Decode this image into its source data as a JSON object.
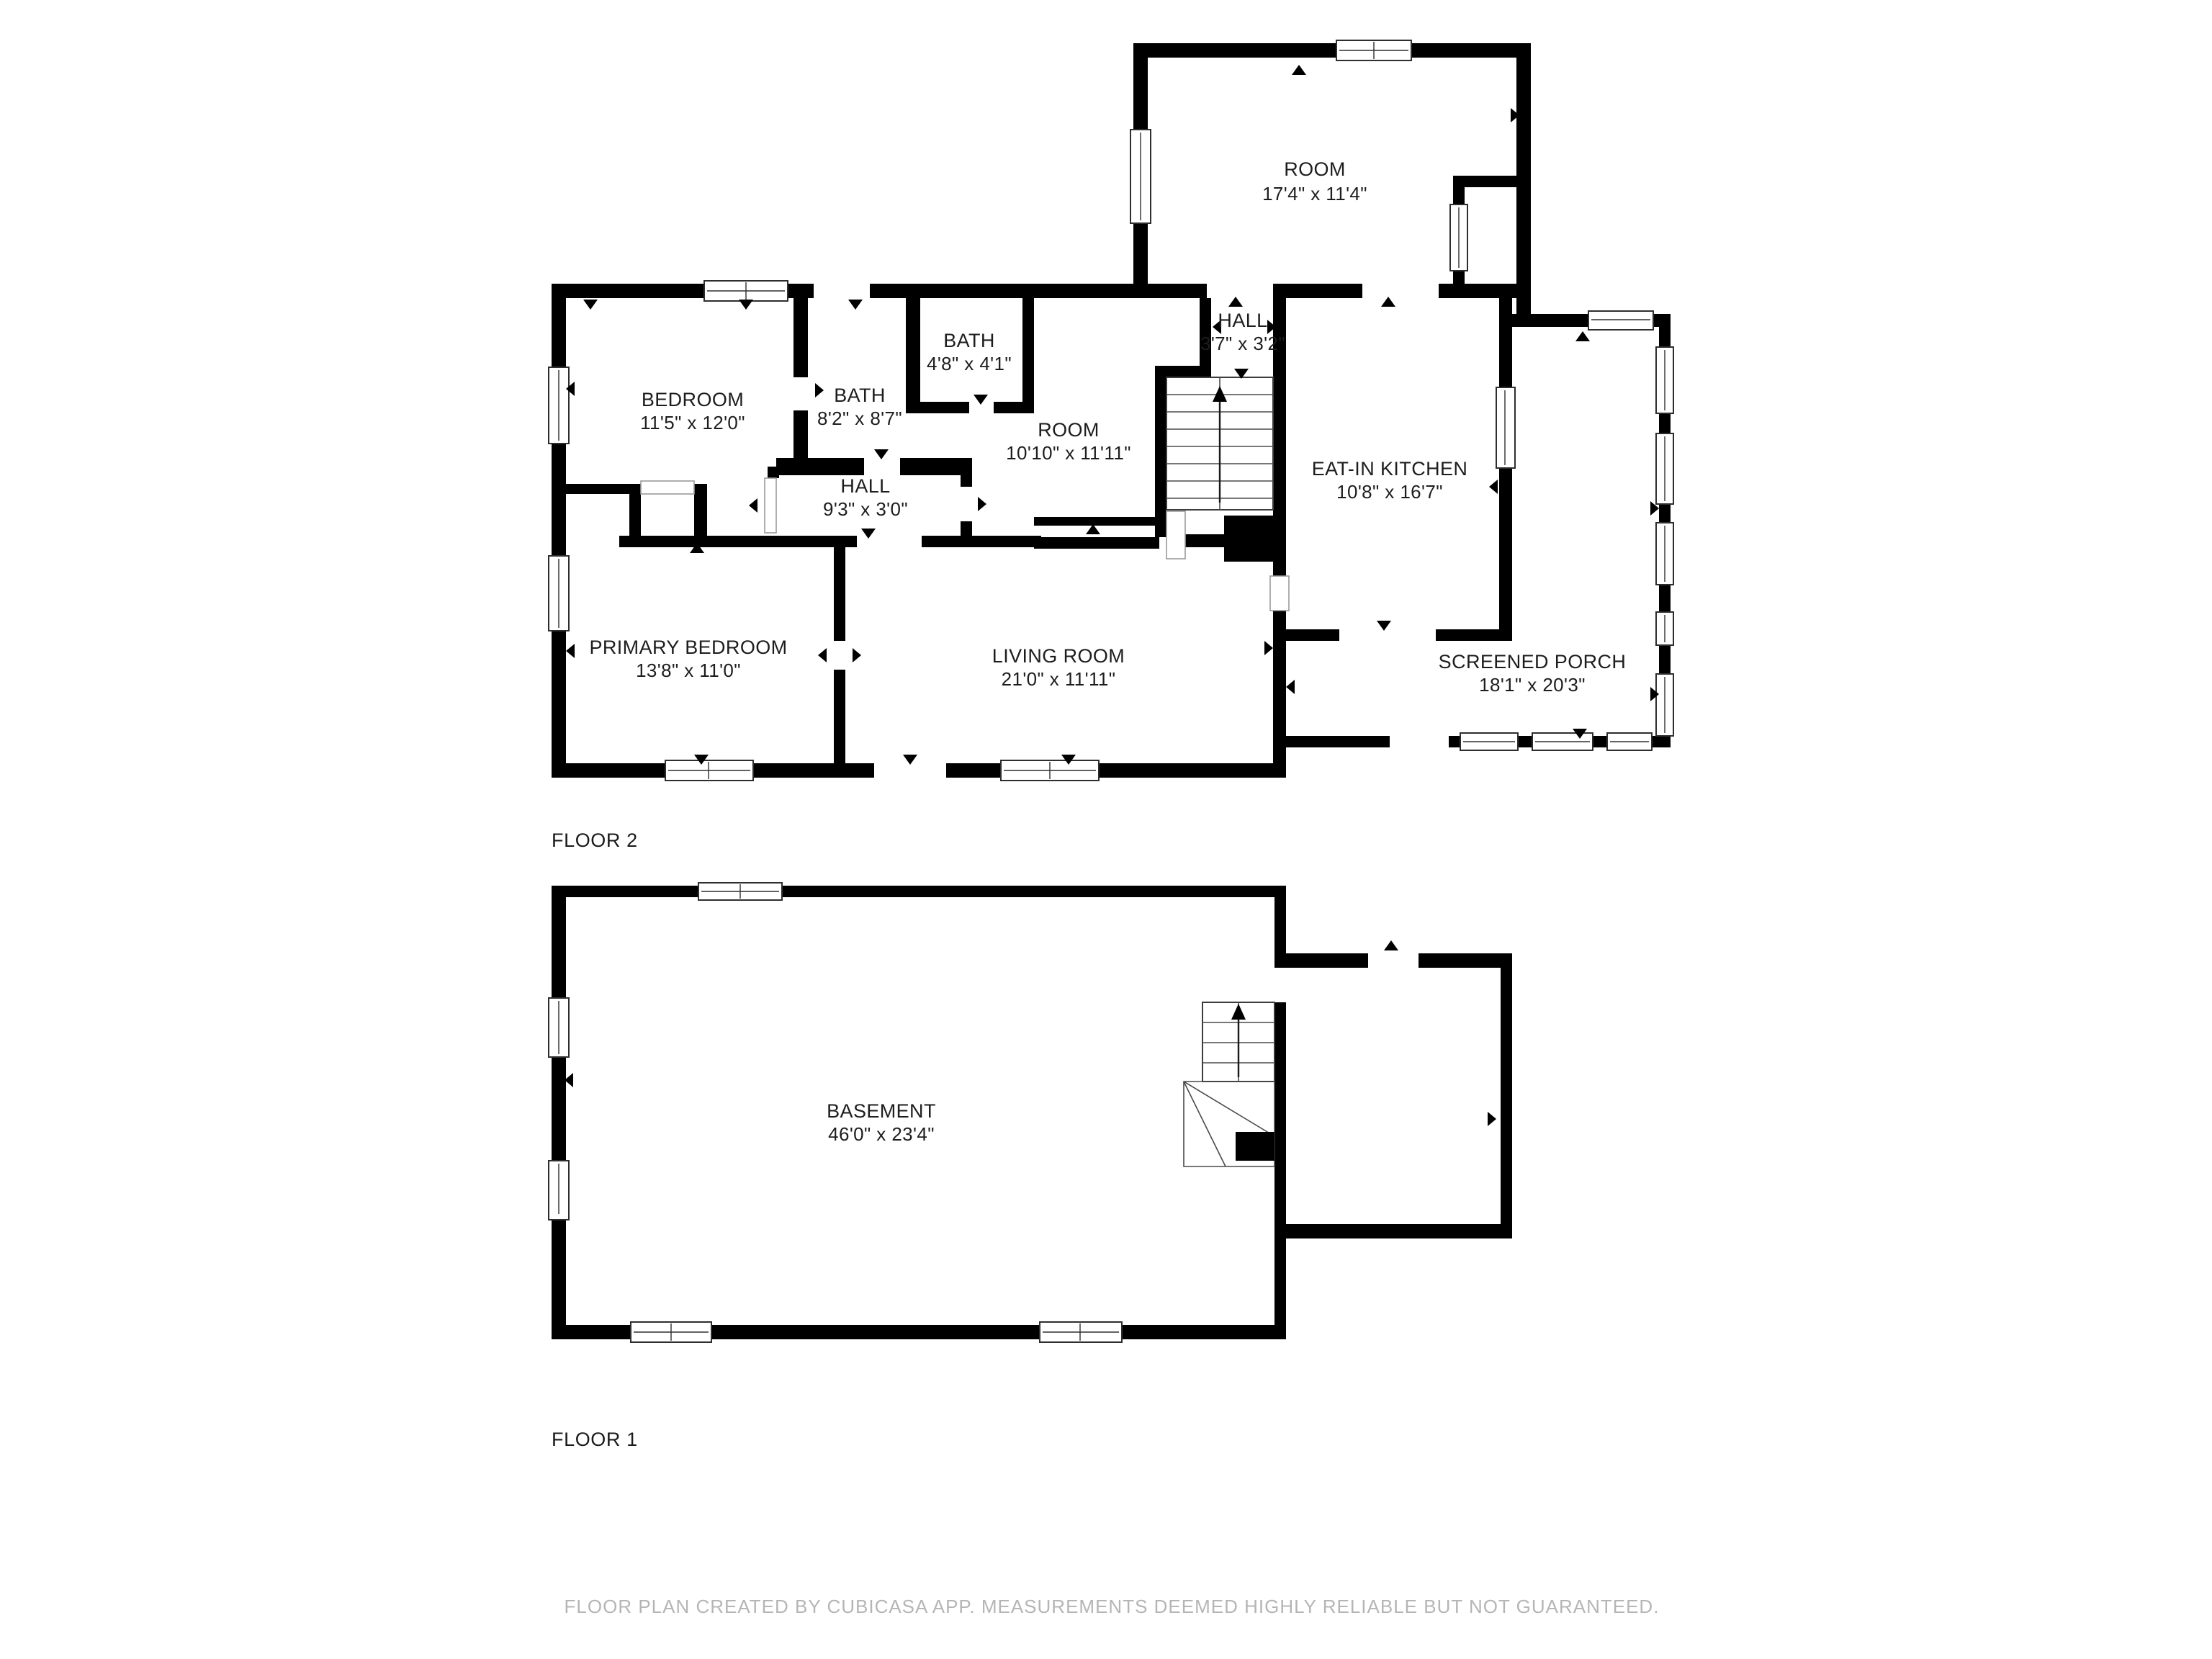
{
  "colors": {
    "wall": "#000000",
    "background": "#ffffff",
    "label_text": "#1d1d1d",
    "footer_text": "#b5b5b5",
    "window_line": "#2e2e2e"
  },
  "floor2": {
    "label": "FLOOR 2",
    "rooms": [
      {
        "name": "ROOM",
        "dims": "17'4\" x 11'4\""
      },
      {
        "name": "BATH",
        "dims": "4'8\" x 4'1\""
      },
      {
        "name": "BATH",
        "dims": "8'2\" x 8'7\""
      },
      {
        "name": "BEDROOM",
        "dims": "11'5\" x 12'0\""
      },
      {
        "name": "HALL",
        "dims": "3'7\" x 3'2\""
      },
      {
        "name": "ROOM",
        "dims": "10'10\" x 11'11\""
      },
      {
        "name": "EAT-IN KITCHEN",
        "dims": "10'8\" x 16'7\""
      },
      {
        "name": "HALL",
        "dims": "9'3\" x 3'0\""
      },
      {
        "name": "PRIMARY BEDROOM",
        "dims": "13'8\" x 11'0\""
      },
      {
        "name": "LIVING ROOM",
        "dims": "21'0\" x 11'11\""
      },
      {
        "name": "SCREENED PORCH",
        "dims": "18'1\" x 20'3\""
      }
    ]
  },
  "floor1": {
    "label": "FLOOR 1",
    "rooms": [
      {
        "name": "BASEMENT",
        "dims": "46'0\" x 23'4\""
      }
    ]
  },
  "footer": {
    "text": "FLOOR PLAN CREATED BY CUBICASA APP. MEASUREMENTS DEEMED HIGHLY RELIABLE BUT NOT GUARANTEED."
  }
}
